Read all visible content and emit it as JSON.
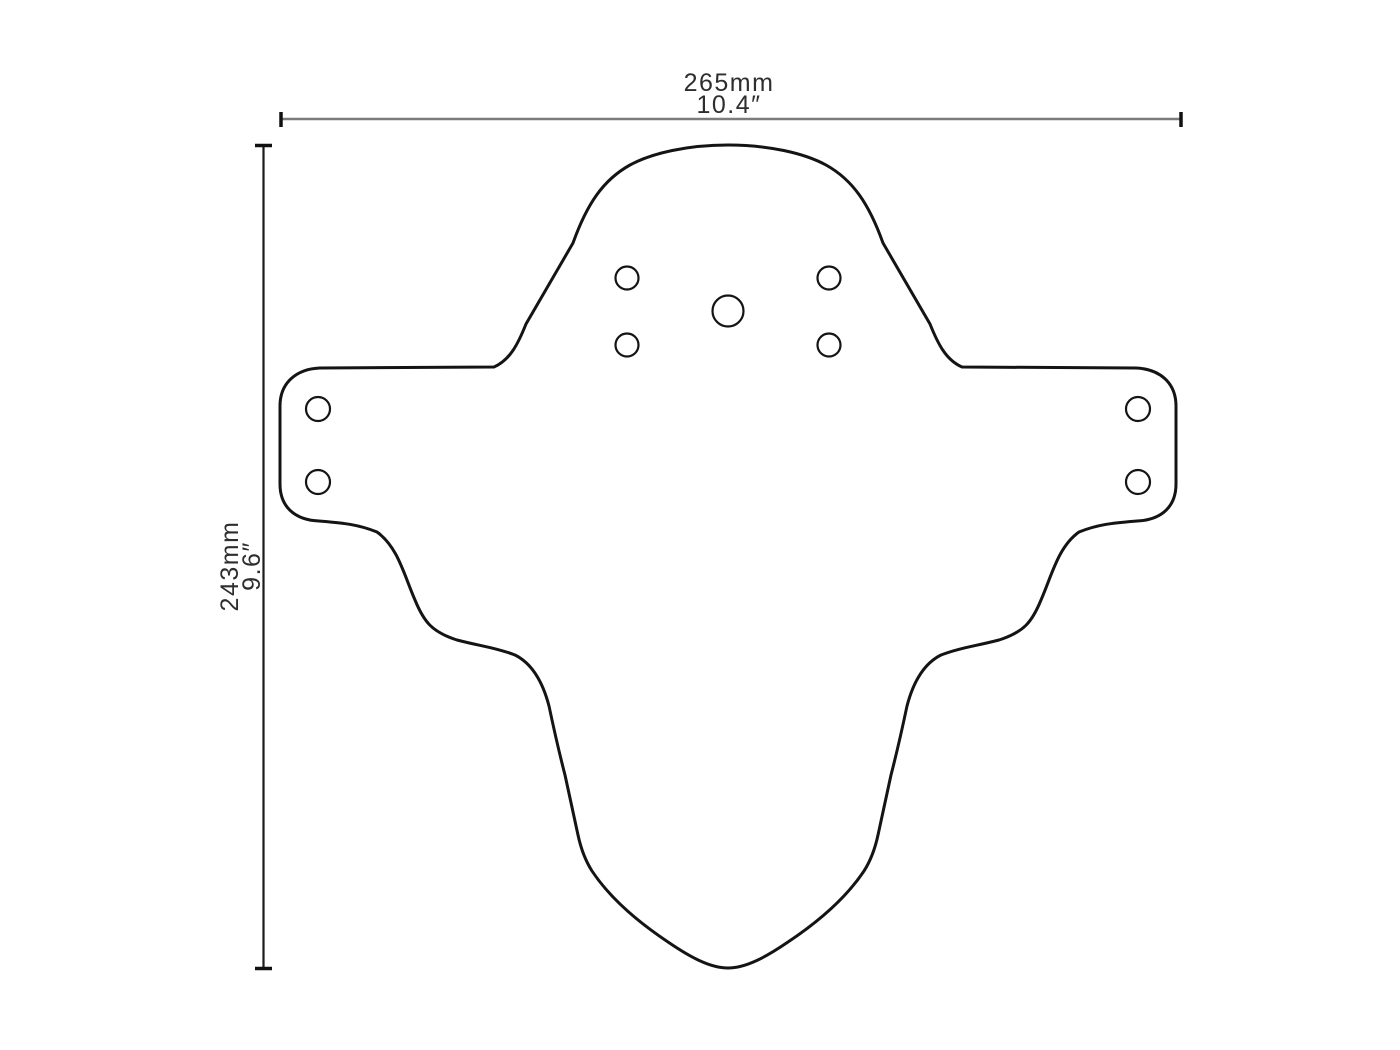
{
  "diagram": {
    "title": "Mudguard template dimension drawing",
    "width_dimension": {
      "metric": "265mm",
      "imperial": "10.4″"
    },
    "height_dimension": {
      "metric": "243mm",
      "imperial": "9.6″"
    },
    "holes": {
      "center_large_count": 1,
      "center_small_count": 4,
      "left_tab_count": 2,
      "right_tab_count": 2
    },
    "colors": {
      "background": "#ffffff",
      "outline": "#141414",
      "hole_stroke": "#141414",
      "dim_line_horizontal": "#7b7b7b",
      "dim_line_vertical": "#1c1c1c",
      "tick": "#111111",
      "label_text": "#2e2e2e"
    }
  }
}
